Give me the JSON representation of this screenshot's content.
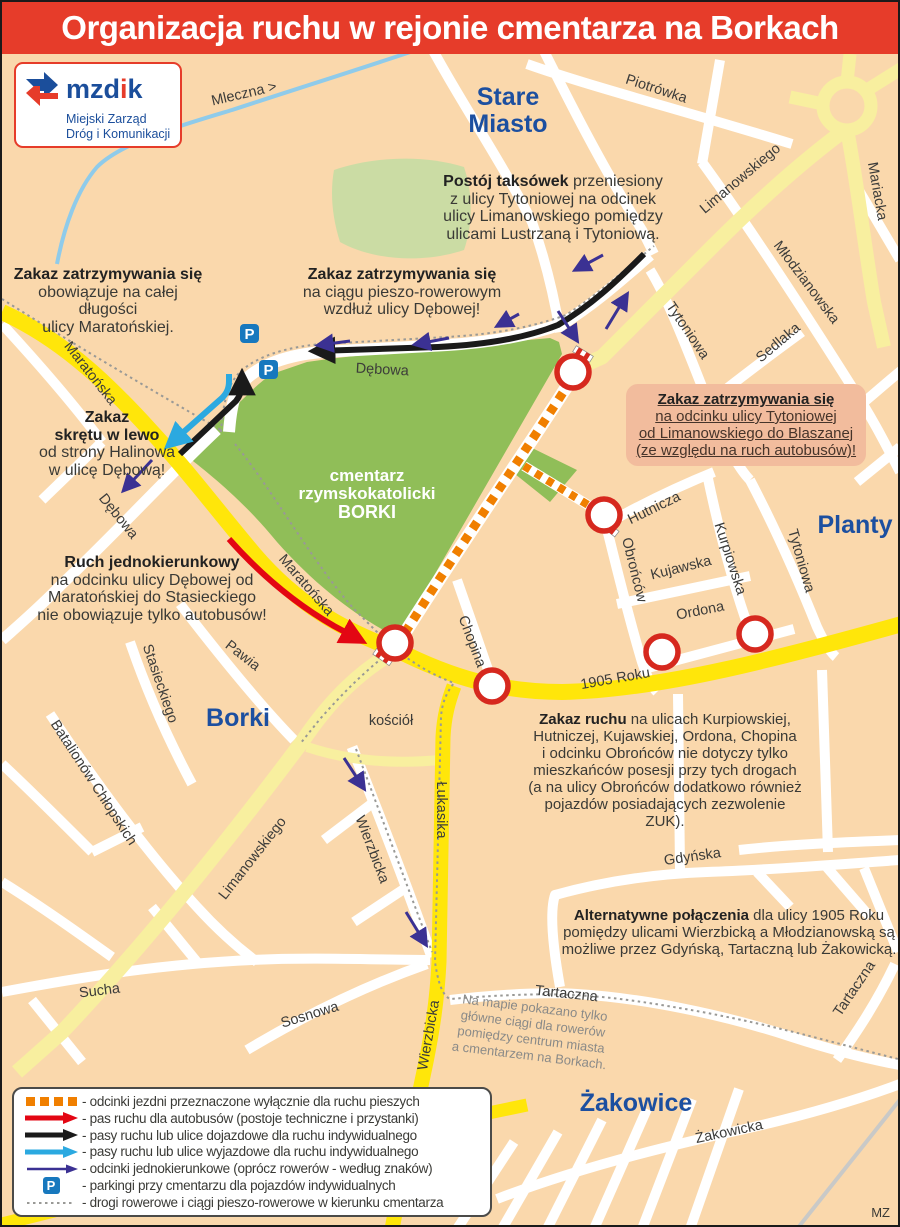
{
  "title": "Organizacja ruchu w rejonie cmentarza na Borkach",
  "credit": "MZ",
  "logo": {
    "name_mzd": "mzd",
    "name_i": "i",
    "name_k": "k",
    "line1": "Miejski Zarząd",
    "line2": "Dróg i Komunikacji"
  },
  "districts": {
    "stare1": "Stare",
    "stare2": "Miasto",
    "planty": "Planty",
    "borki": "Borki",
    "zakowice": "Żakowice"
  },
  "cemetery": {
    "l1": "cmentarz",
    "l2": "rzymskokatolicki",
    "l3": "BORKI"
  },
  "streets": {
    "mleczna": "Mleczna >",
    "piotrowka": "Piotrówka",
    "limanowskiego": "Limanowskiego",
    "mariacka": "Mariacka",
    "mlodzianowska": "Młodzianowska",
    "sedlaka": "Sedlaka",
    "tytoniowa": "Tytoniowa",
    "maratonska": "Maratońska",
    "debowa": "Dębowa",
    "hutnicza": "Hutnicza",
    "obroncow": "Obrońców",
    "kurpiowska": "Kurpiowska",
    "kujawska": "Kujawska",
    "ordona": "Ordona",
    "chopina": "Chopina",
    "roku1905": "1905 Roku",
    "lukasika": "Łukasika",
    "wierzbicka": "Wierzbicka",
    "stasieckiego": "Stasieckiego",
    "pawia": "Pawia",
    "batalionow": "Batalionów Chłopskich",
    "sucha": "Sucha",
    "sosnowa": "Sosnowa",
    "gdynska": "Gdyńska",
    "tartaczna": "Tartaczna",
    "zakowicka": "Żakowicka",
    "kosciol": "kościół"
  },
  "icons": {
    "parking": "P"
  },
  "annotations": {
    "taxi": {
      "lead": "Postój taksówek",
      "rest": " przeniesiony",
      "l2": "z ulicy Tytoniowej na odcinek",
      "l3": "ulicy Limanowskiego pomiędzy",
      "l4": "ulicami Lustrzaną i Tytoniową."
    },
    "maratonska_ban": {
      "lead": "Zakaz zatrzymywania się",
      "l2": "obowiązuje na całej długości",
      "l3": "ulicy Maratońskiej."
    },
    "debowa_ban": {
      "lead": "Zakaz zatrzymywania się",
      "l2": "na ciągu pieszo-rowerowym",
      "l3": "wzdłuż ulicy Dębowej!"
    },
    "left_turn": {
      "lead1": "Zakaz",
      "lead2": "skrętu w lewo",
      "l3": "od strony Halinowa",
      "l4": "w ulicę Dębową!"
    },
    "tytoniowa_box": {
      "lead": "Zakaz zatrzymywania się",
      "l2": "na odcinku ulicy Tytoniowej",
      "l3": "od Limanowskiego do Blaszanej",
      "l4": "(ze względu na ruch autobusów)!"
    },
    "one_way": {
      "lead": "Ruch jednokierunkowy",
      "l2": "na odcinku ulicy Dębowej od",
      "l3": "Maratońskiej do Stasieckiego",
      "l4": "nie obowiązuje tylko autobusów!"
    },
    "zakaz_ruchu": {
      "lead": "Zakaz ruchu",
      "rest": " na ulicach Kurpiowskiej,",
      "l2": "Hutniczej, Kujawskiej, Ordona, Chopina",
      "l3": "i odcinku Obrońców nie dotyczy tylko",
      "l4": "mieszkańców posesji przy tych drogach",
      "l5": "(a na ulicy Obrońców dodatkowo również",
      "l6": "pojazdów posiadających zezwolenie ZUK)."
    },
    "alternatywne": {
      "lead": "Alternatywne połączenia",
      "rest": " dla ulicy 1905 Roku",
      "l2": "pomiędzy ulicami Wierzbicką a Młodzianowską są",
      "l3": "możliwe przez Gdyńską, Tartaczną lub Żakowicką."
    },
    "map_note": {
      "l1": "Na mapie pokazano tylko",
      "l2": "główne ciągi dla rowerów",
      "l3": "pomiędzy centrum miasta",
      "l4": "a cmentarzem na Borkach."
    }
  },
  "legend": {
    "items": [
      {
        "label": "- odcinki jezdni przeznaczone wyłącznie dla ruchu pieszych"
      },
      {
        "label": "- pas ruchu dla autobusów (postoje techniczne i przystanki)"
      },
      {
        "label": "- pasy ruchu lub ulice dojazdowe dla ruchu indywidualnego"
      },
      {
        "label": "- pasy ruchu lub ulice wyjazdowe dla ruchu indywidualnego"
      },
      {
        "label": "- odcinki jednokierunkowe (oprócz rowerów - według znaków)"
      },
      {
        "label": "- parkingi przy cmentarzu dla pojazdów indywidualnych"
      },
      {
        "label": "- drogi rowerowe i ciągi pieszo-rowerowe w kierunku cmentarza"
      }
    ]
  },
  "colors": {
    "header_red": "#E63C2A",
    "map_bg": "#FAD8AC",
    "road_yellow": "#FFE60A",
    "road_pale_yellow": "#F8EF9F",
    "road_white": "#FFFFFF",
    "cemetery_green": "#90BE58",
    "park_green": "#CBDCA4",
    "closed_orange": "#F07F00",
    "one_way_navy": "#3B3193",
    "exit_blue": "#2BA9E0",
    "bus_red": "#E30613",
    "inbound_black": "#1A1A1A",
    "no_entry_red": "#D6281E",
    "parking_blue": "#1778BE",
    "district_blue": "#1C4FA0",
    "river_blue": "#8FCBEA"
  }
}
